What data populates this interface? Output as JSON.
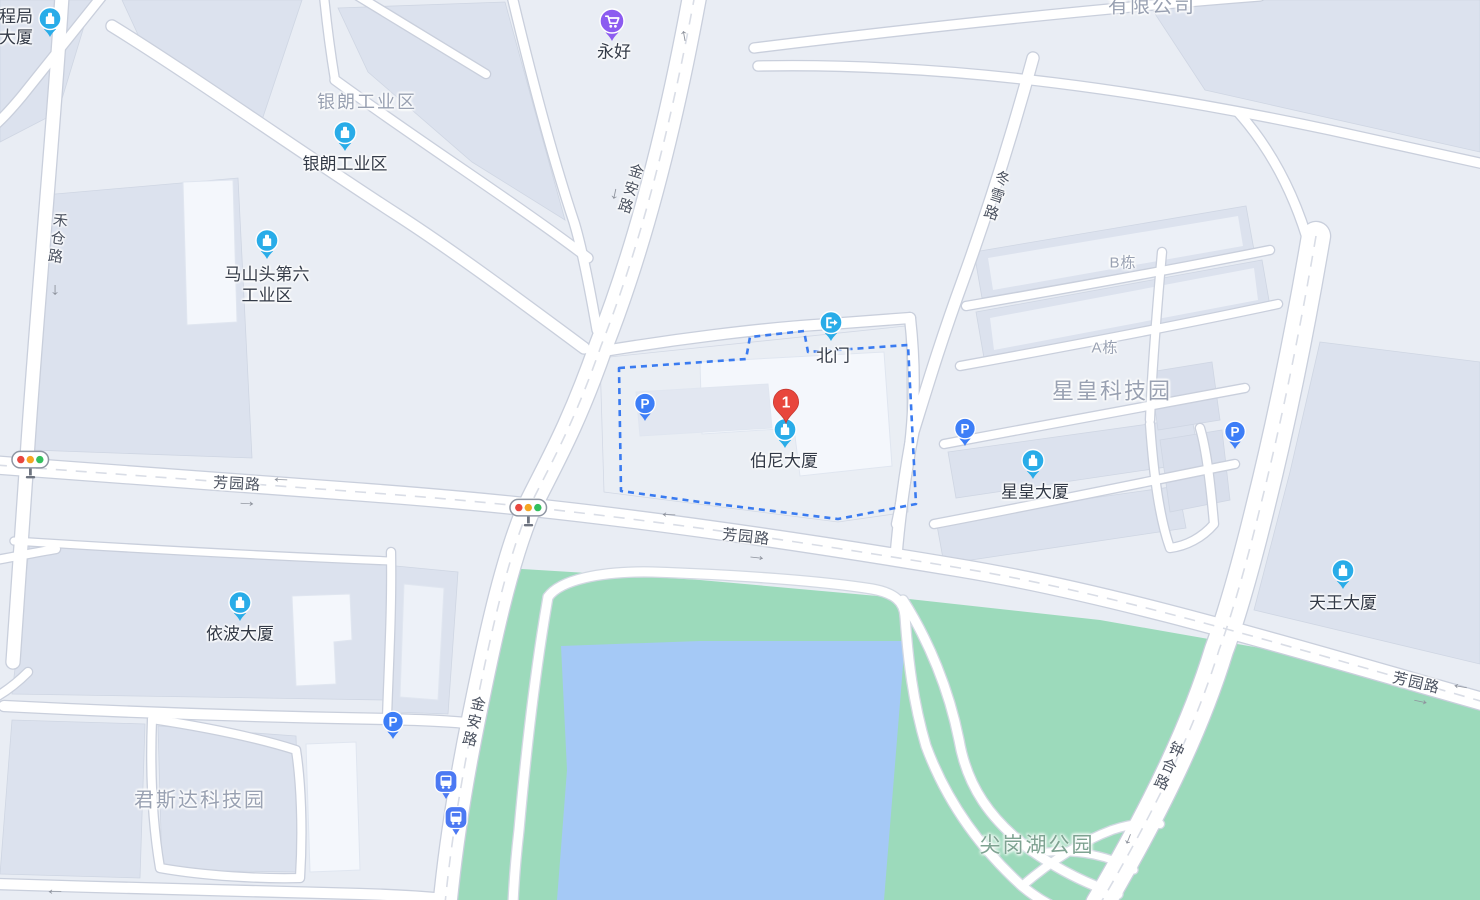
{
  "app": {
    "title": "地图 - 伯尼大厦"
  },
  "canvas": {
    "width": 1480,
    "height": 900
  },
  "colors": {
    "land": "#e9edf4",
    "building": "#dce2ee",
    "building_mid": "#e2e7f1",
    "building_light": "#f4f7fc",
    "compound_fill": "#eaeef4",
    "road_fill": "#ffffff",
    "road_casing": "#c9cfdc",
    "lane_dash": "#d9dde6",
    "park": "#9cdabb",
    "lake": "#a5c9f6",
    "compound_dash": "#3a7bf0",
    "poi_blue": "#29ace8",
    "parking_blue": "#3d7ef7",
    "bus_blue": "#4c79f3",
    "shop_purple": "#8c5bf0",
    "marker_red": "#e8463c",
    "light_red": "#e8473f",
    "light_amber": "#f5a623",
    "light_green": "#34c05e",
    "poi_label": "#333a47",
    "area_label": "#99a1b2",
    "road_label": "#4b5260",
    "park_label": "#7fa392",
    "arrow": "#8f949e"
  },
  "destination": {
    "number": "1",
    "x": 786,
    "y": 424,
    "name": "destination-marker-1"
  },
  "markers": [
    {
      "name": "poi-pin-chengju-tower",
      "icon": "building-pin",
      "x": 50,
      "y": 38
    },
    {
      "name": "poi-pin-yinlang-industrial",
      "icon": "building-pin",
      "x": 345,
      "y": 152
    },
    {
      "name": "poi-pin-mashantou-sixth",
      "icon": "building-pin",
      "x": 267,
      "y": 260
    },
    {
      "name": "poi-pin-boni-tower",
      "icon": "building-pin",
      "x": 785,
      "y": 449
    },
    {
      "name": "poi-pin-xinghuang-tower",
      "icon": "building-pin",
      "x": 1033,
      "y": 480
    },
    {
      "name": "poi-pin-yibo-tower",
      "icon": "building-pin",
      "x": 240,
      "y": 622
    },
    {
      "name": "poi-pin-tianwang-tower",
      "icon": "building-pin",
      "x": 1343,
      "y": 590
    },
    {
      "name": "north-gate-pin",
      "icon": "gate-pin",
      "x": 831,
      "y": 342
    },
    {
      "name": "shop-pin-yonghao",
      "icon": "shop-pin",
      "x": 612,
      "y": 42
    },
    {
      "name": "parking-pin-1",
      "icon": "parking-pin",
      "glyph": "P",
      "x": 645,
      "y": 422
    },
    {
      "name": "parking-pin-2",
      "icon": "parking-pin",
      "glyph": "P",
      "x": 965,
      "y": 447
    },
    {
      "name": "parking-pin-3",
      "icon": "parking-pin",
      "glyph": "P",
      "x": 1235,
      "y": 450
    },
    {
      "name": "parking-pin-4",
      "icon": "parking-pin",
      "glyph": "P",
      "x": 393,
      "y": 740
    },
    {
      "name": "bus-stop-pin-1",
      "icon": "bus-pin",
      "x": 446,
      "y": 800
    },
    {
      "name": "bus-stop-pin-2",
      "icon": "bus-pin",
      "x": 456,
      "y": 836
    },
    {
      "name": "traffic-light-1",
      "icon": "traffic-light",
      "x": 30,
      "y": 460,
      "interactable": "false"
    },
    {
      "name": "traffic-light-2",
      "icon": "traffic-light",
      "x": 528,
      "y": 508,
      "interactable": "false"
    }
  ],
  "labels": [
    {
      "name": "poi-label-chengju-tower",
      "kind": "poi",
      "text": "程局\n大厦",
      "x": 16,
      "y": 27
    },
    {
      "name": "poi-label-yinlang",
      "kind": "poi",
      "text": "银朗工业区",
      "x": 345,
      "y": 164
    },
    {
      "name": "poi-label-mashantou",
      "kind": "poi",
      "text": "马山头第六\n工业区",
      "x": 267,
      "y": 285
    },
    {
      "name": "poi-label-yonghao",
      "kind": "poi",
      "text": "永好",
      "x": 614,
      "y": 52
    },
    {
      "name": "poi-label-north-gate",
      "kind": "poi",
      "text": "北门",
      "x": 833,
      "y": 356
    },
    {
      "name": "poi-label-boni-tower",
      "kind": "poi",
      "text": "伯尼大厦",
      "x": 784,
      "y": 461
    },
    {
      "name": "poi-label-xinghuang-tower",
      "kind": "poi",
      "text": "星皇大厦",
      "x": 1035,
      "y": 492
    },
    {
      "name": "poi-label-yibo-tower",
      "kind": "poi",
      "text": "依波大厦",
      "x": 240,
      "y": 634
    },
    {
      "name": "poi-label-tianwang-tower",
      "kind": "poi",
      "text": "天王大厦",
      "x": 1343,
      "y": 603
    },
    {
      "name": "area-label-yinlang",
      "kind": "area",
      "text": "银朗工业区",
      "x": 367,
      "y": 102,
      "size": 18
    },
    {
      "name": "area-label-youxiangongsi",
      "kind": "area",
      "text": "有限公司",
      "x": 1152,
      "y": 7,
      "size": 20
    },
    {
      "name": "area-label-xinghuang-park",
      "kind": "area",
      "text": "星皇科技园",
      "x": 1112,
      "y": 391,
      "size": 22
    },
    {
      "name": "area-label-junsida-park",
      "kind": "area",
      "text": "君斯达科技园",
      "x": 200,
      "y": 801,
      "size": 20
    },
    {
      "name": "block-label-b-dong",
      "kind": "block",
      "text": "B栋",
      "x": 1123,
      "y": 264
    },
    {
      "name": "block-label-a-dong",
      "kind": "block",
      "text": "A栋",
      "x": 1105,
      "y": 349
    },
    {
      "name": "park-label-jiangang-lake",
      "kind": "park",
      "text": "尖岗湖公园",
      "x": 1037,
      "y": 846
    },
    {
      "name": "road-label-hecang",
      "kind": "road",
      "text": "禾仓路",
      "x": 56,
      "y": 239,
      "vertical": true,
      "rotate": 8
    },
    {
      "name": "road-label-jinan-north",
      "kind": "road",
      "text": "金安路",
      "x": 629,
      "y": 189,
      "vertical": true,
      "rotate": 17
    },
    {
      "name": "road-label-jinan-south",
      "kind": "road",
      "text": "金安路",
      "x": 472,
      "y": 722,
      "vertical": true,
      "rotate": 13
    },
    {
      "name": "road-label-dongxue",
      "kind": "road",
      "text": "冬雪路",
      "x": 995,
      "y": 196,
      "vertical": true,
      "rotate": 18
    },
    {
      "name": "road-label-zhonghe",
      "kind": "road",
      "text": "钟合路",
      "x": 1167,
      "y": 766,
      "vertical": true,
      "rotate": 24
    },
    {
      "name": "road-label-fangyuan-west",
      "kind": "road",
      "text": "芳园路",
      "x": 237,
      "y": 485,
      "rotate": 3
    },
    {
      "name": "road-label-fangyuan-center",
      "kind": "road",
      "text": "芳园路",
      "x": 746,
      "y": 538,
      "rotate": 6
    },
    {
      "name": "road-label-fangyuan-east",
      "kind": "road",
      "text": "芳园路",
      "x": 1416,
      "y": 684,
      "rotate": 13
    }
  ],
  "arrows": [
    {
      "name": "road-arrow-up-jinan",
      "dir": "up",
      "x": 684,
      "y": 35,
      "rotate": -10
    },
    {
      "name": "road-arrow-down-jinan",
      "dir": "down",
      "x": 615,
      "y": 193,
      "rotate": 12
    },
    {
      "name": "road-arrow-down-hecang",
      "dir": "down",
      "x": 55,
      "y": 289,
      "rotate": 0
    },
    {
      "name": "road-arrow-left-fangyuan-w",
      "dir": "left",
      "x": 281,
      "y": 477,
      "rotate": 2
    },
    {
      "name": "road-arrow-right-fangyuan-w",
      "dir": "right",
      "x": 247,
      "y": 501,
      "rotate": 3
    },
    {
      "name": "road-arrow-left-fangyuan-c",
      "dir": "left",
      "x": 669,
      "y": 512,
      "rotate": 2
    },
    {
      "name": "road-arrow-right-fangyuan-c",
      "dir": "right",
      "x": 757,
      "y": 555,
      "rotate": 6
    },
    {
      "name": "road-arrow-left-fangyuan-e",
      "dir": "left",
      "x": 1461,
      "y": 684,
      "rotate": 10
    },
    {
      "name": "road-arrow-right-fangyuan-e",
      "dir": "right",
      "x": 1421,
      "y": 699,
      "rotate": 12
    },
    {
      "name": "road-arrow-down-zhonghe",
      "dir": "down",
      "x": 1129,
      "y": 838,
      "rotate": 22
    },
    {
      "name": "road-arrow-left-south",
      "dir": "left",
      "x": 55,
      "y": 889,
      "rotate": 0
    }
  ]
}
